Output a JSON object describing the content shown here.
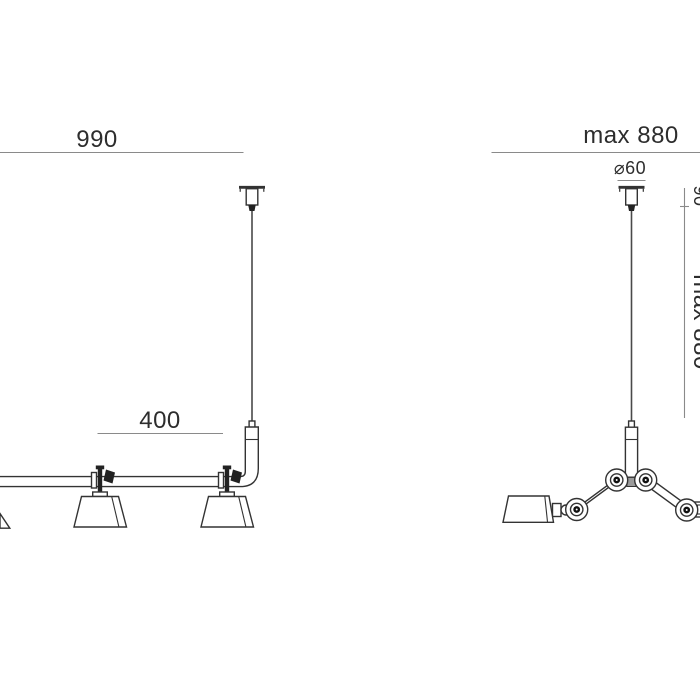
{
  "title": "Pendant lamp technical dimension drawing, front views of two suspension lamps",
  "colors": {
    "background": "#ffffff",
    "drawing_line": "#333333",
    "dimension_line": "#8a8a8a",
    "text": "#2d2d2d",
    "dark_metal": "#222222"
  },
  "left_drawing": {
    "name": "rail pendant with two downward shades, ceiling cord at right, rail cut off at left image edge",
    "width_label": "990",
    "shade_spacing_label": "400"
  },
  "right_drawing": {
    "name": "two-arm chandelier pendant with central stem, articulated arms and hinged joints",
    "width_label": "max 880",
    "canopy_diameter_label": "⌀60",
    "height_label": "max 880",
    "canopy_height_label": "90"
  }
}
